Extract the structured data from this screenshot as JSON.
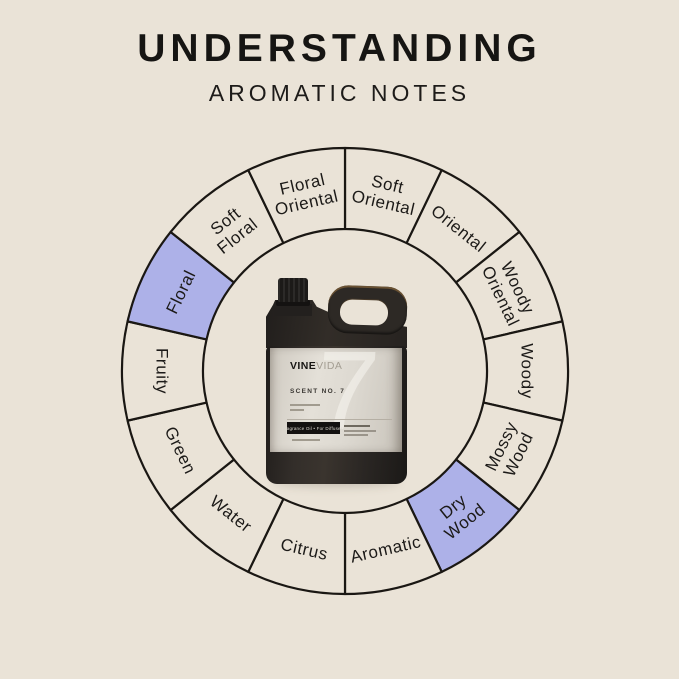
{
  "page": {
    "background": "#eae3d7"
  },
  "header": {
    "title": "UNDERSTANDING",
    "subtitle": "AROMATIC NOTES"
  },
  "wheel": {
    "outline_color": "#1a1713",
    "segment_fill": "#eae3d7",
    "highlight_fill": "#adb1e8",
    "label_color": "#1c1a18",
    "segments": [
      {
        "label": "Soft Oriental",
        "lines": [
          "Soft",
          "Oriental"
        ],
        "highlighted": false
      },
      {
        "label": "Oriental",
        "lines": [
          "Oriental"
        ],
        "highlighted": false
      },
      {
        "label": "Woody Oriental",
        "lines": [
          "Woody",
          "Oriental"
        ],
        "highlighted": false
      },
      {
        "label": "Woody",
        "lines": [
          "Woody"
        ],
        "highlighted": false
      },
      {
        "label": "Mossy Wood",
        "lines": [
          "Mossy",
          "Wood"
        ],
        "highlighted": false
      },
      {
        "label": "Dry Wood",
        "lines": [
          "Dry",
          "Wood"
        ],
        "highlighted": true
      },
      {
        "label": "Aromatic",
        "lines": [
          "Aromatic"
        ],
        "highlighted": false
      },
      {
        "label": "Citrus",
        "lines": [
          "Citrus"
        ],
        "highlighted": false
      },
      {
        "label": "Water",
        "lines": [
          "Water"
        ],
        "highlighted": false
      },
      {
        "label": "Green",
        "lines": [
          "Green"
        ],
        "highlighted": false
      },
      {
        "label": "Fruity",
        "lines": [
          "Fruity"
        ],
        "highlighted": false
      },
      {
        "label": "Floral",
        "lines": [
          "Floral"
        ],
        "highlighted": true
      },
      {
        "label": "Soft Floral",
        "lines": [
          "Soft",
          "Floral"
        ],
        "highlighted": false
      },
      {
        "label": "Floral Oriental",
        "lines": [
          "Floral",
          "Oriental"
        ],
        "highlighted": false
      }
    ]
  },
  "bottle": {
    "brand_bold": "VINE",
    "brand_light": "VIDA",
    "scent_label": "SCENT NO. 7",
    "badge": "Fragrance Oil • For Diffusers",
    "watermark": "7"
  }
}
